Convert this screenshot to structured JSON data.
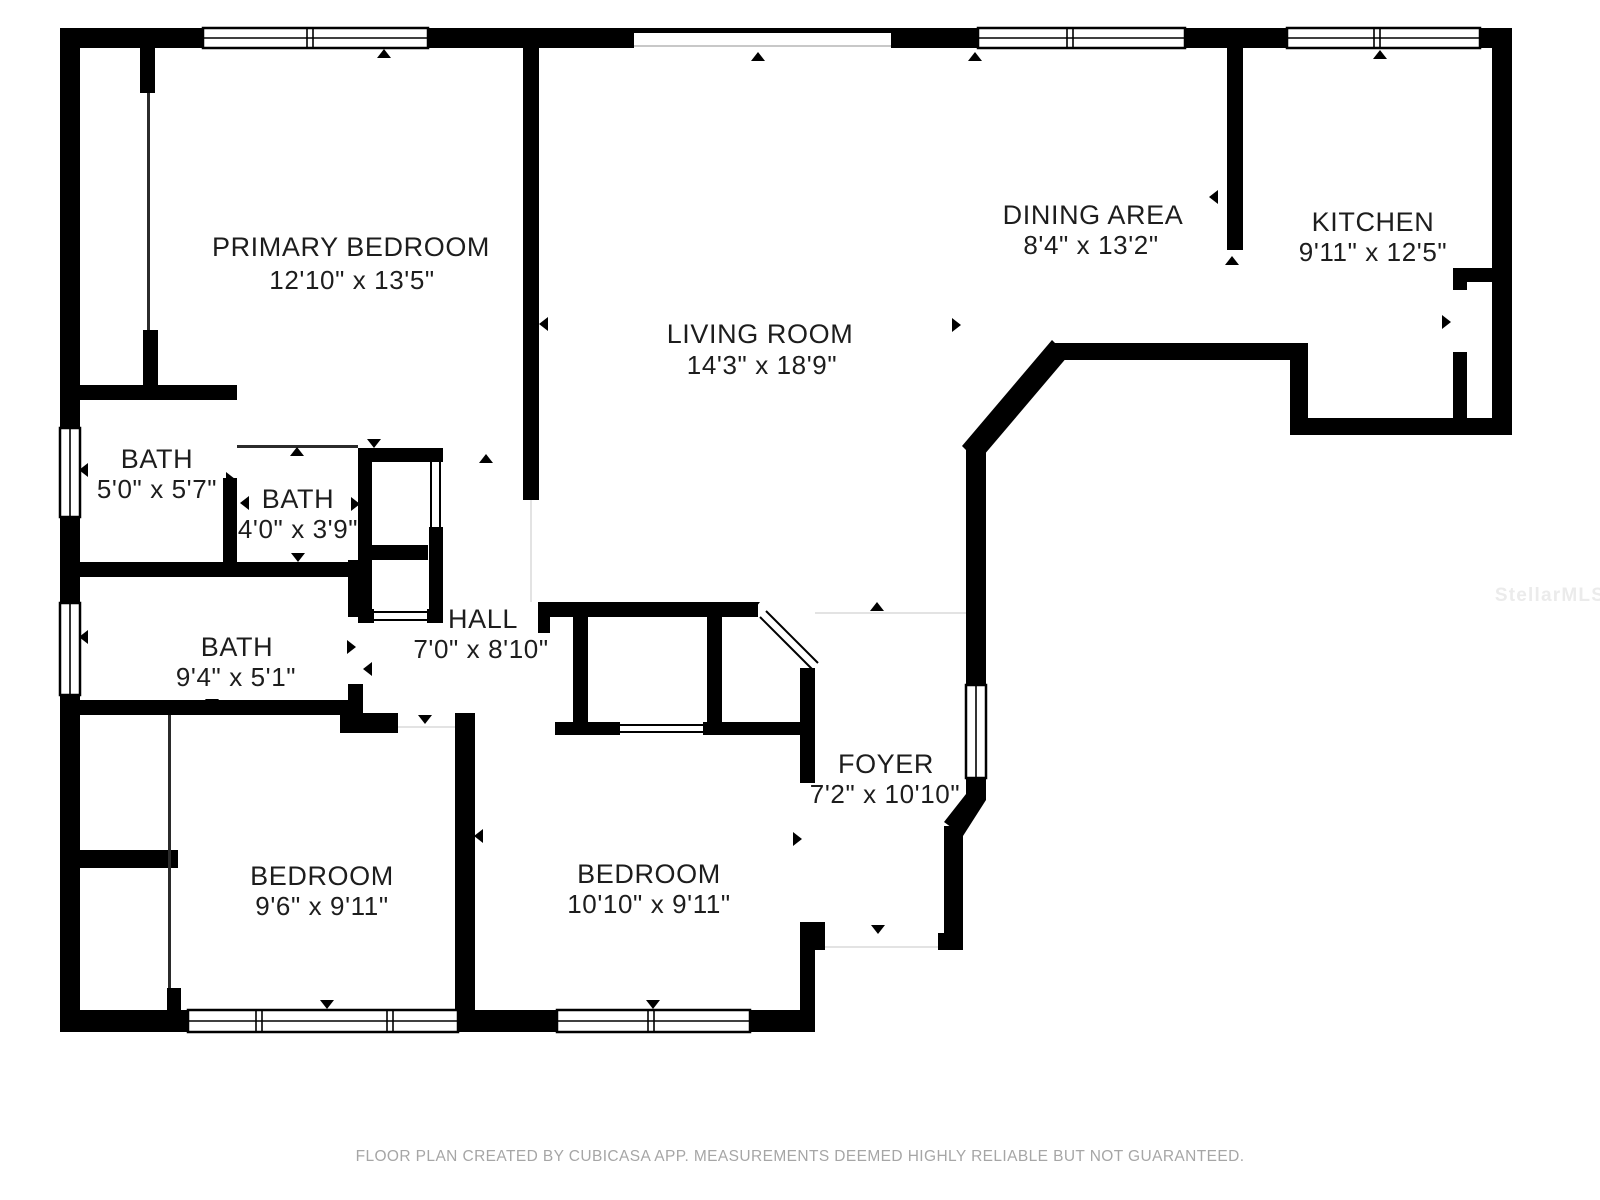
{
  "page": {
    "background": "#ffffff"
  },
  "colors": {
    "wall": "#000000",
    "label": "#1d1d1d",
    "watermark": "#ebebeb",
    "footer_text": "#a6a6a6"
  },
  "watermark": "StellarMLS",
  "footer": {
    "text": "FLOOR PLAN CREATED BY CUBICASA APP. MEASUREMENTS DEEMED HIGHLY RELIABLE BUT NOT GUARANTEED."
  },
  "rooms": [
    {
      "id": "primary-bedroom",
      "name": "PRIMARY BEDROOM",
      "dims": "12'10\" x 13'5\""
    },
    {
      "id": "living-room",
      "name": "LIVING ROOM",
      "dims": "14'3\" x 18'9\""
    },
    {
      "id": "dining-area",
      "name": "DINING AREA",
      "dims": "8'4\" x 13'2\""
    },
    {
      "id": "kitchen",
      "name": "KITCHEN",
      "dims": "9'11\" x 12'5\""
    },
    {
      "id": "bath-1",
      "name": "BATH",
      "dims": "5'0\" x 5'7\""
    },
    {
      "id": "bath-2",
      "name": "BATH",
      "dims": "4'0\" x 3'9\""
    },
    {
      "id": "bath-3",
      "name": "BATH",
      "dims": "9'4\" x 5'1\""
    },
    {
      "id": "hall",
      "name": "HALL",
      "dims": "7'0\" x 8'10\""
    },
    {
      "id": "bedroom-1",
      "name": "BEDROOM",
      "dims": "9'6\" x 9'11\""
    },
    {
      "id": "bedroom-2",
      "name": "BEDROOM",
      "dims": "10'10\" x 9'11\""
    },
    {
      "id": "foyer",
      "name": "FOYER",
      "dims": "7'2\" x 10'10\""
    }
  ]
}
